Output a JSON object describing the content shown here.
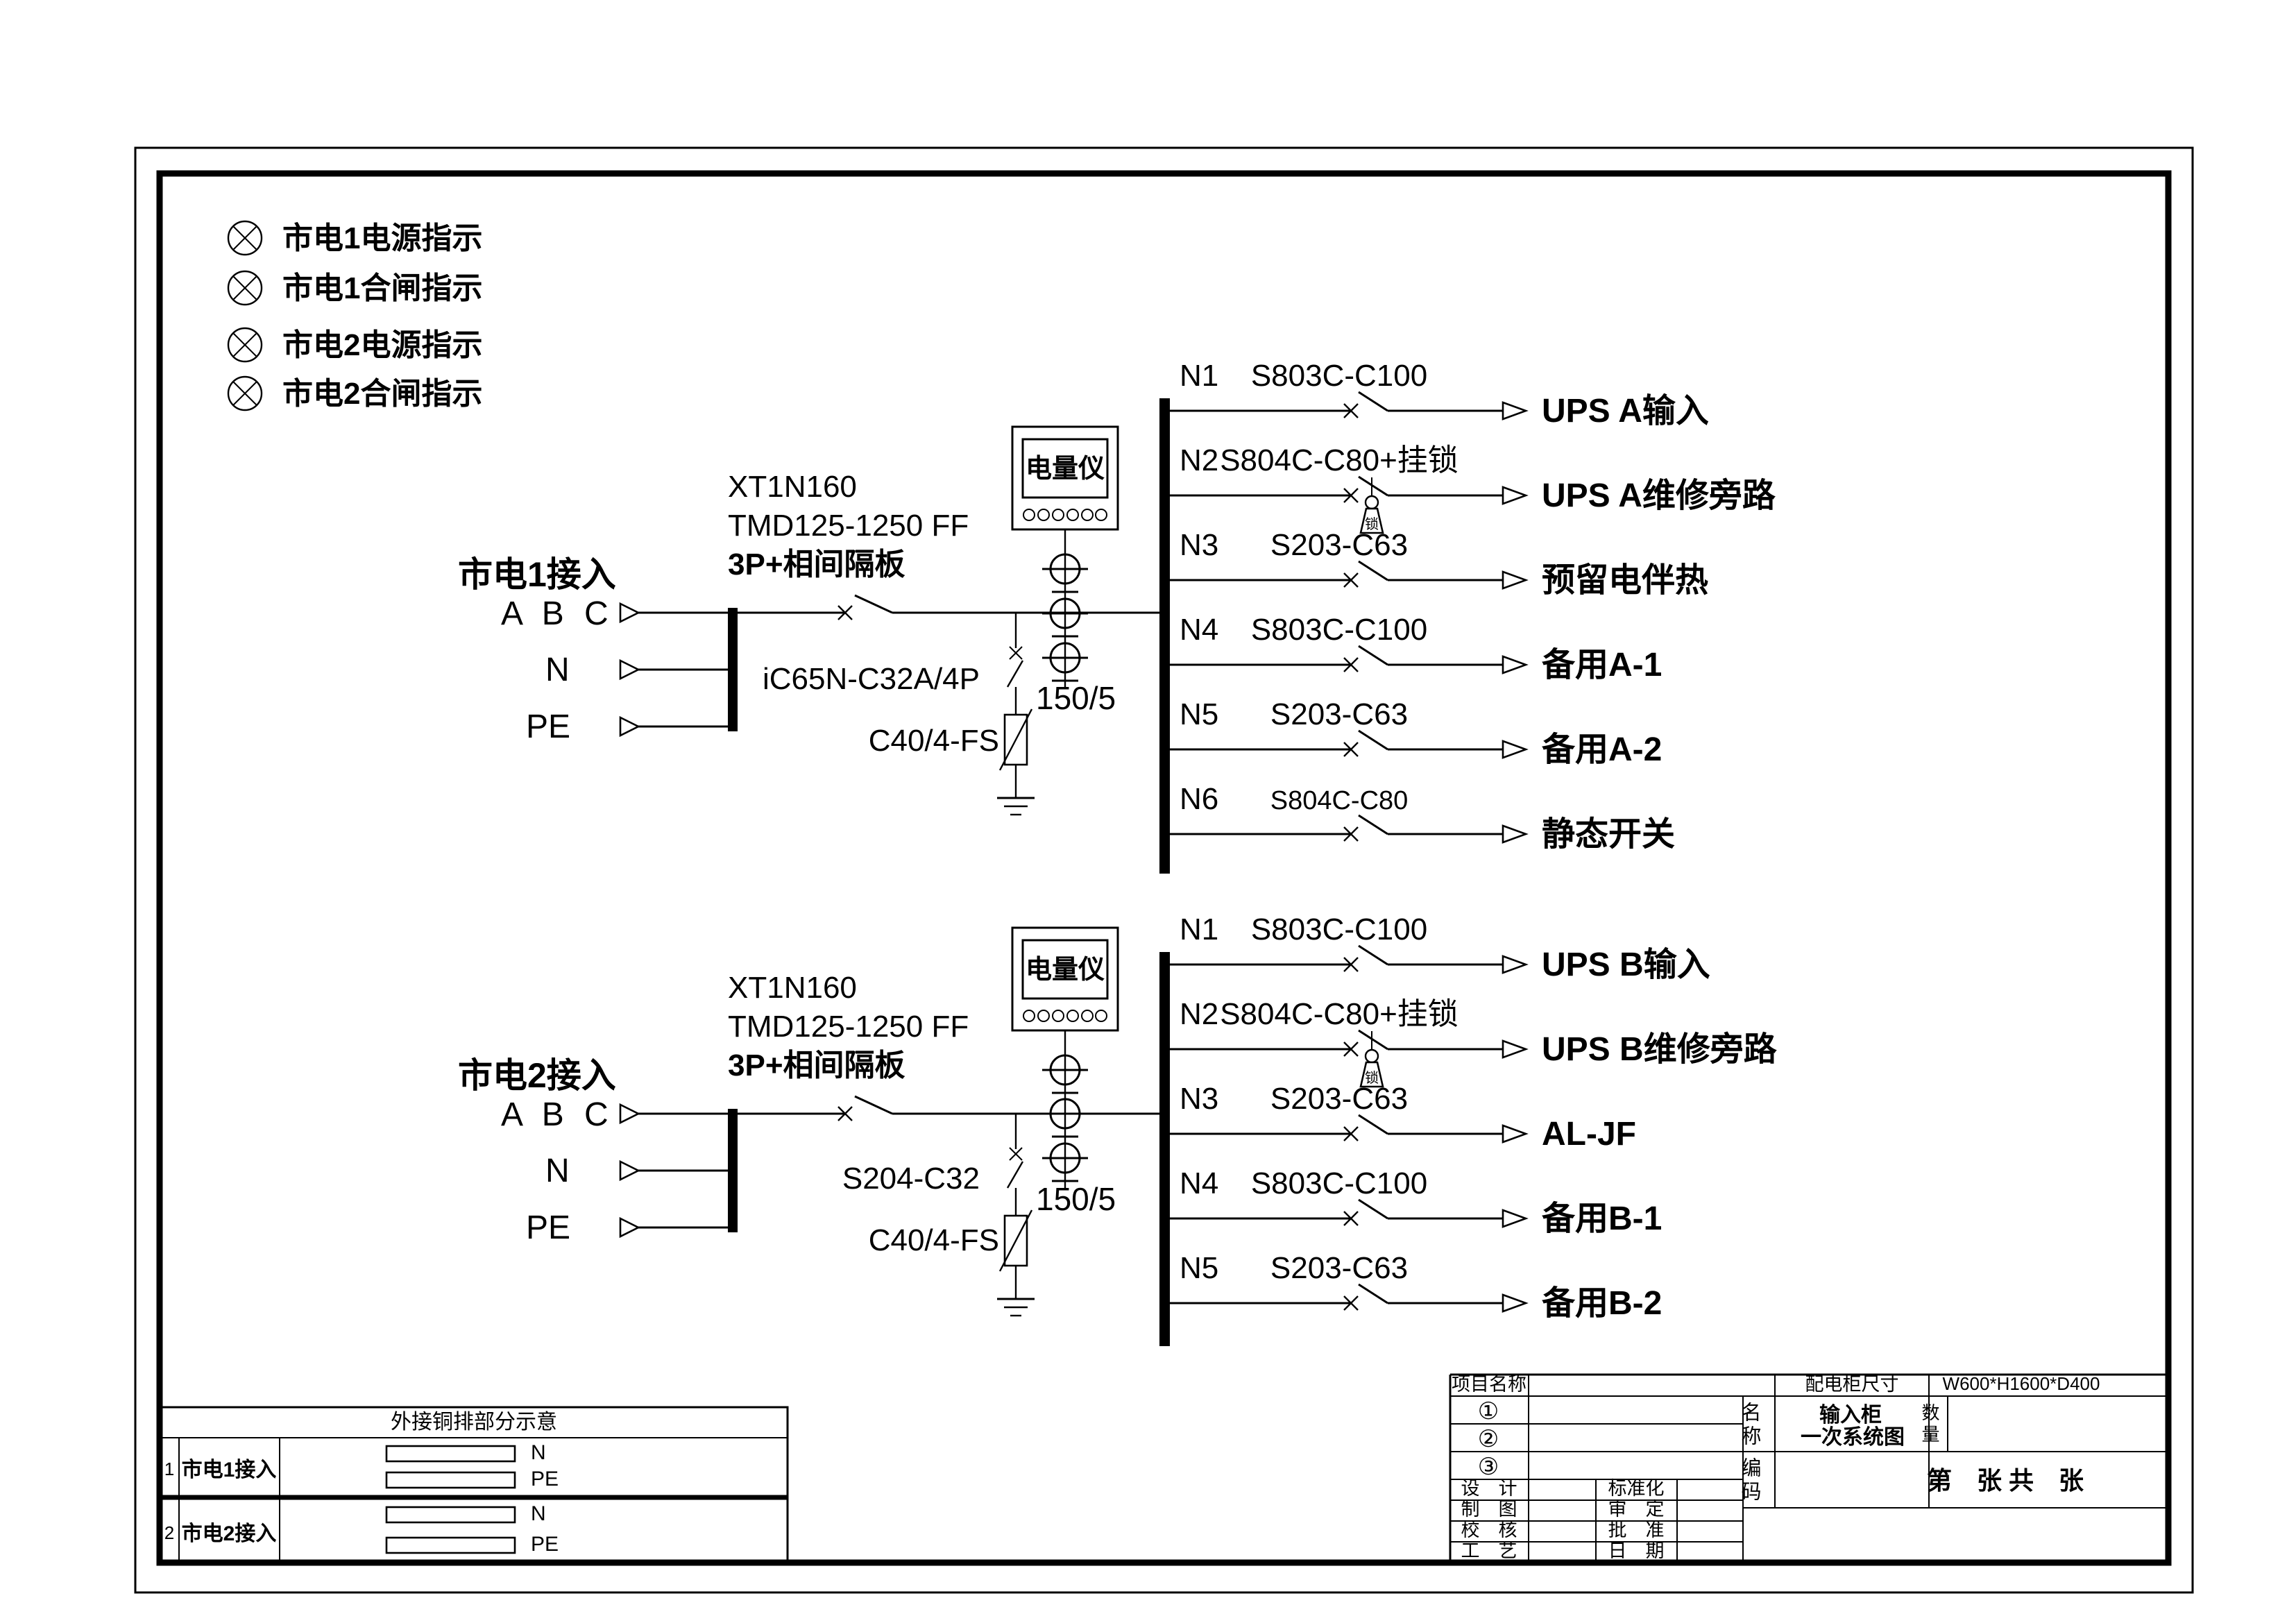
{
  "drawing_title": "输入柜一次系统图",
  "indicators": [
    {
      "label": "市电1电源指示"
    },
    {
      "label": "市电1合闸指示"
    },
    {
      "label": "市电2电源指示"
    },
    {
      "label": "市电2合闸指示"
    }
  ],
  "symbols": {
    "padlock_char": "锁"
  },
  "sections": [
    {
      "feed_label": "市电1接入",
      "phase_label": "A B C",
      "neutral_label": "N",
      "pe_label": "PE",
      "main_breaker_lines": [
        "XT1N160",
        "TMD125-1250 FF",
        "3P+相间隔板"
      ],
      "spd_breaker_label": "iC65N-C32A/4P",
      "spd_label": "C40/4-FS",
      "meter_label": "电量仪",
      "ct_ratio": "150/5",
      "rows": [
        {
          "id": "N1",
          "model": "S803C-C100",
          "load": "UPS A输入"
        },
        {
          "id": "N2",
          "model": "S804C-C80+挂锁",
          "load": "UPS A维修旁路"
        },
        {
          "id": "N3",
          "model": "S203-C63",
          "load": "预留电伴热"
        },
        {
          "id": "N4",
          "model": "S803C-C100",
          "load": "备用A-1"
        },
        {
          "id": "N5",
          "model": "S203-C63",
          "load": "备用A-2"
        },
        {
          "id": "N6",
          "model": "S804C-C80",
          "load": "静态开关"
        }
      ]
    },
    {
      "feed_label": "市电2接入",
      "phase_label": "A B C",
      "neutral_label": "N",
      "pe_label": "PE",
      "main_breaker_lines": [
        "XT1N160",
        "TMD125-1250 FF",
        "3P+相间隔板"
      ],
      "spd_breaker_label": "S204-C32",
      "spd_label": "C40/4-FS",
      "meter_label": "电量仪",
      "ct_ratio": "150/5",
      "rows": [
        {
          "id": "N1",
          "model": "S803C-C100",
          "load": "UPS B输入"
        },
        {
          "id": "N2",
          "model": "S804C-C80+挂锁",
          "load": "UPS B维修旁路"
        },
        {
          "id": "N3",
          "model": "S203-C63",
          "load": "AL-JF"
        },
        {
          "id": "N4",
          "model": "S803C-C100",
          "load": "备用B-1"
        },
        {
          "id": "N5",
          "model": "S203-C63",
          "load": "备用B-2"
        }
      ]
    }
  ],
  "copper_table": {
    "title": "外接铜排部分示意",
    "rows": [
      {
        "no": "1",
        "name": "市电1接入",
        "bar1": "N",
        "bar2": "PE"
      },
      {
        "no": "2",
        "name": "市电2接入",
        "bar1": "N",
        "bar2": "PE"
      }
    ]
  },
  "title_block": {
    "project_label": "项目名称",
    "size_label": "配电柜尺寸",
    "size_value": "W600*H1600*D400",
    "item1": "①",
    "item2": "②",
    "item3": "③",
    "name_label": "名称",
    "name_line1": "输入柜",
    "name_line2": "一次系统图",
    "qty_label": "数量",
    "code_label": "编码",
    "sheet_text": "第　张 共　张",
    "design_label": "设　计",
    "draft_label": "制　图",
    "check_label": "校　核",
    "craft_label": "工　艺",
    "std_label": "标准化",
    "review_label": "审　定",
    "approve_label": "批　准",
    "date_label": "日　期"
  }
}
